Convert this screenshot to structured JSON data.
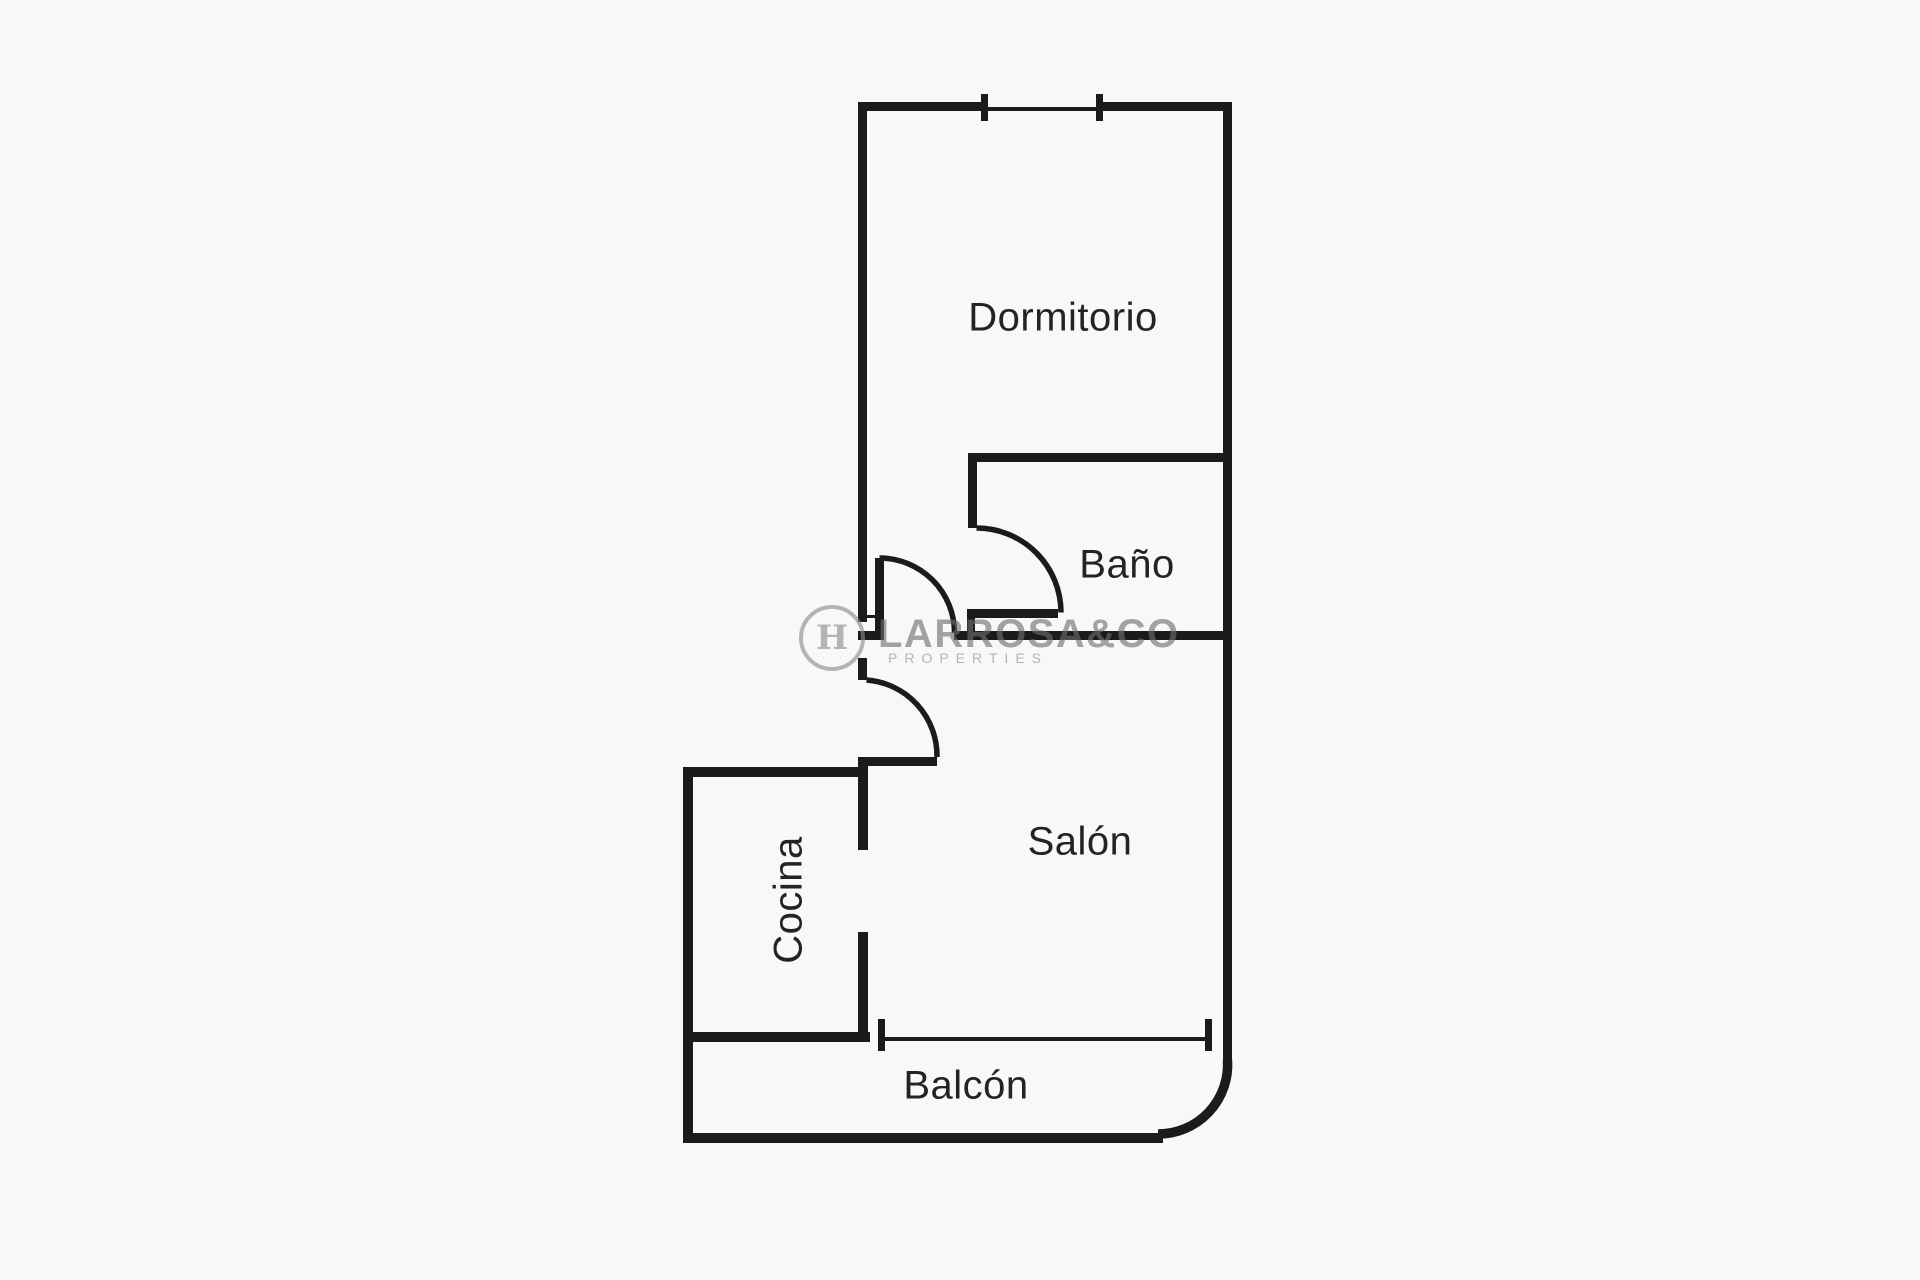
{
  "page": {
    "background_color": "#f8f8f8",
    "wall_color": "#1b1b1b",
    "label_color": "#232323",
    "watermark_color": "#8c8c8c"
  },
  "plan": {
    "type": "floor-plan",
    "rooms": [
      {
        "id": "dormitorio",
        "label": "Dormitorio"
      },
      {
        "id": "bano",
        "label": "Baño"
      },
      {
        "id": "salon",
        "label": "Salón"
      },
      {
        "id": "cocina",
        "label": "Cocina"
      },
      {
        "id": "balcon",
        "label": "Balcón"
      }
    ]
  },
  "watermark": {
    "logo_letter": "H",
    "name": "LARROSA&CO",
    "tagline": "PROPERTIES"
  }
}
